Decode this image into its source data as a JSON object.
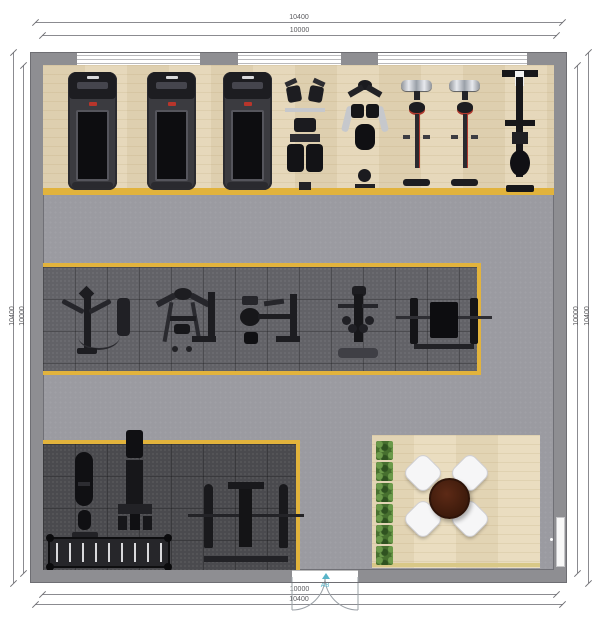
{
  "plan": {
    "title": "gym floor plan",
    "door_label": "A8",
    "dimensions": {
      "top_outer": "10400",
      "top_inner": "10000",
      "bottom_inner": "10000",
      "bottom_outer": "10400",
      "left_outer": "10400",
      "left_inner": "10000",
      "right_inner": "10000",
      "right_outer": "10400"
    },
    "zones": {
      "cardio_strip": "wood-floor cardio zone",
      "middle_strength_mat": "rubber-mat machine zone",
      "bottom_strength_mat": "rubber-mat free-weight zone",
      "lounge": "wood-floor lounge zone",
      "walkway": "gray walkway"
    },
    "equipment": {
      "cardio_row": [
        "treadmill",
        "treadmill",
        "treadmill",
        "seated-leg-machine",
        "multi-station-machine",
        "exercise-bike",
        "exercise-bike",
        "barbell-plate-rack"
      ],
      "middle_row": [
        "pec-deck-machine",
        "lat-pulldown-machine",
        "seated-row-machine",
        "dumbbell-stand-with-bench",
        "bench-press-station"
      ],
      "bottom_row": [
        "weight-stack-machine",
        "smith-machine",
        "dumbbell-rack",
        "bench-press-station"
      ],
      "lounge_items": [
        "planter-row",
        "round-table",
        "chair",
        "chair",
        "chair",
        "chair"
      ]
    },
    "architecture": {
      "top_windows": 3,
      "bottom_double_door": 1,
      "right_side_door": 1
    },
    "colors": {
      "wall": "#8e8e92",
      "wood_floor": "#e3d6ba",
      "walkway_floor": "#9b9ba1",
      "mat_mid": "#626267",
      "mat_dark": "#4a4a4e",
      "accent_border": "#e2b33c",
      "door_label": "#58b4c8",
      "table": "#47200f",
      "plant": "#47702f",
      "equipment_dark": "#1d1d21",
      "accent_red": "#b0392e"
    }
  }
}
